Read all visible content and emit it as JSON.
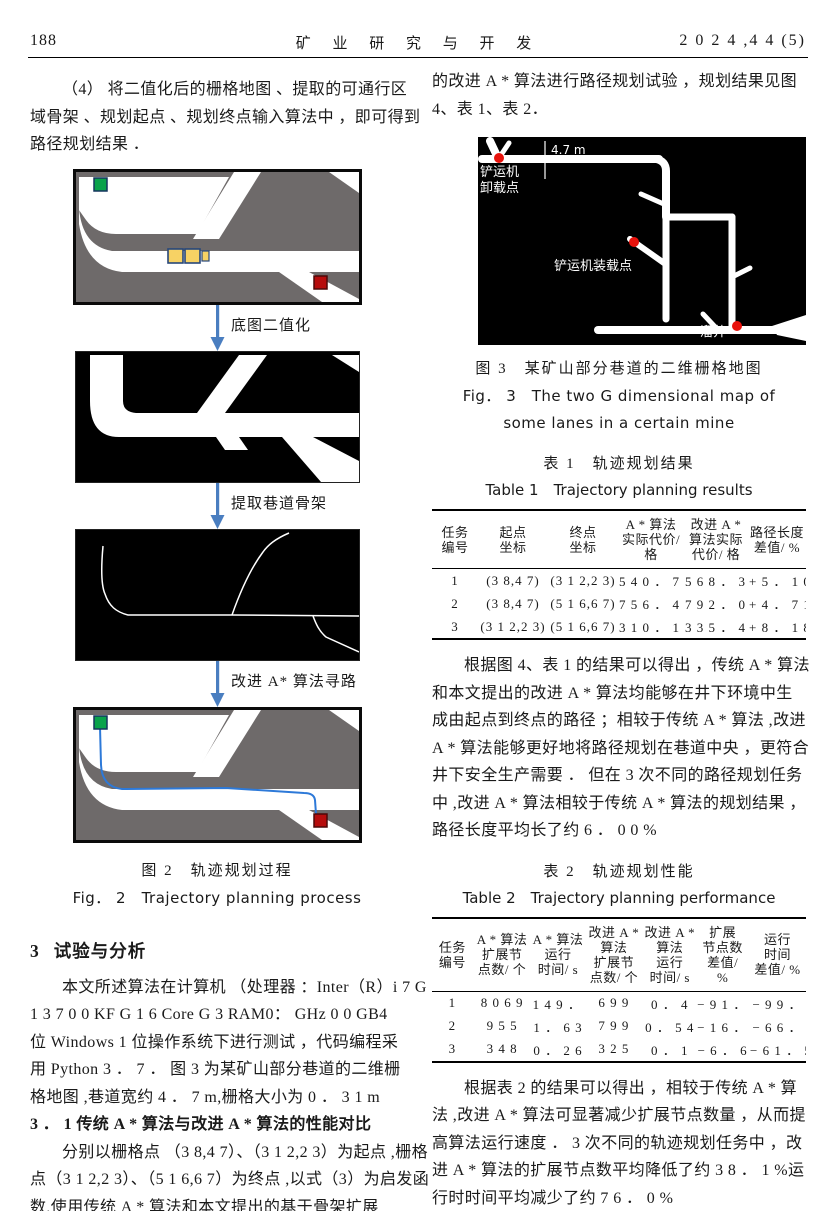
{
  "colors": {
    "map_gray": "#6e6a6a",
    "arrow_blue": "#4a7ec0",
    "path_blue": "#2d79d8",
    "marker_green": "#09a24b",
    "marker_red": "#b60c0c",
    "vehicle_yellow": "#f7d264",
    "dot_red": "#e8120c"
  },
  "header": {
    "page_number": "188",
    "journal": "矿 业 研 究 与 开 发",
    "issue": "2 0 2 4 ,4 4 (5)"
  },
  "left": {
    "para1": [
      "（4） 将二值化后的栅格地图 、提取的可通行区",
      "域骨架 、规划起点 、规划终点输入算法中 ，即可得到",
      "路径规划结果 ．"
    ],
    "figure2": {
      "arrow1": "底图二值化",
      "arrow2": "提取巷道骨架",
      "arrow3": "改进 A* 算法寻路",
      "caption_zh": "图 2　轨迹规划过程",
      "caption_en": "Fig． 2　Trajectory planning process"
    },
    "section": {
      "num": "3",
      "title": "试验与分析"
    },
    "para2": [
      "本文所述算法在计算机 （处理器 ：Inter（R）i 7 G",
      "1 3 7 0 0 KF G 1 6 Core G 3 RAM0： GHz 0 0 GB4",
      "位 Windows 1 位操作系统下进行测试 ，代码编程采",
      "用 Python 3 ． 7 ． 图 3 为某矿山部分巷道的二维栅",
      "格地图 ,巷道宽约 4 ． 7 m,栅格大小为 0 ． 3 1 m"
    ],
    "subsection": "3 ． 1 传统 A * 算法与改进 A * 算法的性能对比",
    "para3": [
      "分别以栅格点 （3 8,4 7）、（3 1 2,2 3）为起点 ,栅格",
      "点（3 1 2,2 3）、（5 1 6,6 7）为终点 ,以式（3）为启发函",
      "数,使用传统 A * 算法和本文提出的基于骨架扩展"
    ]
  },
  "right": {
    "para1": [
      "的改进 A * 算法进行路径规划试验 ，规划结果见图",
      "4、表 1、表 2．"
    ],
    "figure3": {
      "scale_label": "4.7 m",
      "label_unload_1": "铲运机",
      "label_unload_2": "卸载点",
      "label_load": "铲运机装载点",
      "label_orepass": "溜井",
      "caption_zh": "图 3　某矿山部分巷道的二维栅格地图",
      "caption_en1": "Fig． 3　The two G dimensional map of",
      "caption_en2": "some lanes in a certain mine"
    },
    "table1": {
      "title_zh": "表 1　轨迹规划结果",
      "title_en": "Table 1　Trajectory planning results",
      "headers": [
        "任务\n编号",
        "起点\n坐标",
        "终点\n坐标",
        "A * 算法\n实际代价/\n格",
        "改进 A *\n算法实际\n代价/ 格",
        "路径长度\n差值/ %"
      ],
      "rows": [
        [
          "1",
          "(3 8,4 7)",
          "(3 1 2,2 3)",
          "5 4 0 ． 7 8",
          "5 6 8 ． 3 4",
          "+ 5 ． 1 0"
        ],
        [
          "2",
          "(3 8,4 7)",
          "(5 1 6,6 7)",
          "7 5 6 ． 4 1",
          "7 9 2 ． 0 2",
          "+ 4 ． 7 1"
        ],
        [
          "3",
          "(3 1 2,2 3)",
          "(5 1 6,6 7)",
          "3 1 0 ． 1 0",
          "3 3 5 ． 4 7",
          "+ 8 ． 1 8"
        ]
      ]
    },
    "para2": [
      "根据图 4、表 1 的结果可以得出 ，传统 A * 算法",
      "和本文提出的改进 A * 算法均能够在井下环境中生",
      "成由起点到终点的路径 ；相较于传统 A * 算法 ,改进",
      "A * 算法能够更好地将路径规划在巷道中央 ，更符合",
      "井下安全生产需要 ． 但在 3 次不同的路径规划任务",
      "中 ,改进 A * 算法相较于传统 A * 算法的规划结果 ，",
      "路径长度平均长了约 6 ． 0 0 %"
    ],
    "table2": {
      "title_zh": "表 2　轨迹规划性能",
      "title_en": "Table 2　Trajectory planning performance",
      "headers": [
        "任务\n编号",
        "A * 算法\n扩展节\n点数/ 个",
        "A * 算法\n运行\n时间/ s",
        "改进 A *\n算法\n扩展节\n点数/ 个",
        "改进 A *\n算法\n运行\n时间/ s",
        "扩展\n节点数\n差值/\n%",
        "运行\n时间\n差值/ %"
      ],
      "rows": [
        [
          "1",
          "8 0 6 9",
          "1 4 9 ． 4 3",
          "6 9 9",
          "0 ． 4",
          "− 9 1 ． 3",
          "− 9 9 ．"
        ],
        [
          "2",
          "9 5 5",
          "1 ． 6 3",
          "7 9 9",
          "0 ． 5 4",
          "− 1 6 ． 3",
          "− 6 6 ．"
        ],
        [
          "3",
          "3 4 8",
          "0 ． 2 6",
          "3 2 5",
          "0 ． 1",
          "− 6 ． 6",
          "− 6 1 ． 5"
        ]
      ]
    },
    "para3": [
      "根据表 2 的结果可以得出 ，相较于传统 A * 算",
      "法 ,改进 A * 算法可显著减少扩展节点数量 ，从而提",
      "高算法运行速度 ． 3 次不同的轨迹规划任务中 ，改",
      "进 A * 算法的扩展节点数平均降低了约 3 8 ． 1 %运",
      "行时时间平均减少了约 7 6 ． 0 %"
    ],
    "para4": [
      "综上所述 ,改进 A * 算法可大幅提高运行速度和轨",
      "迹规划结果的安全性 ,但会少量增加规划路径的长度 ．"
    ]
  }
}
